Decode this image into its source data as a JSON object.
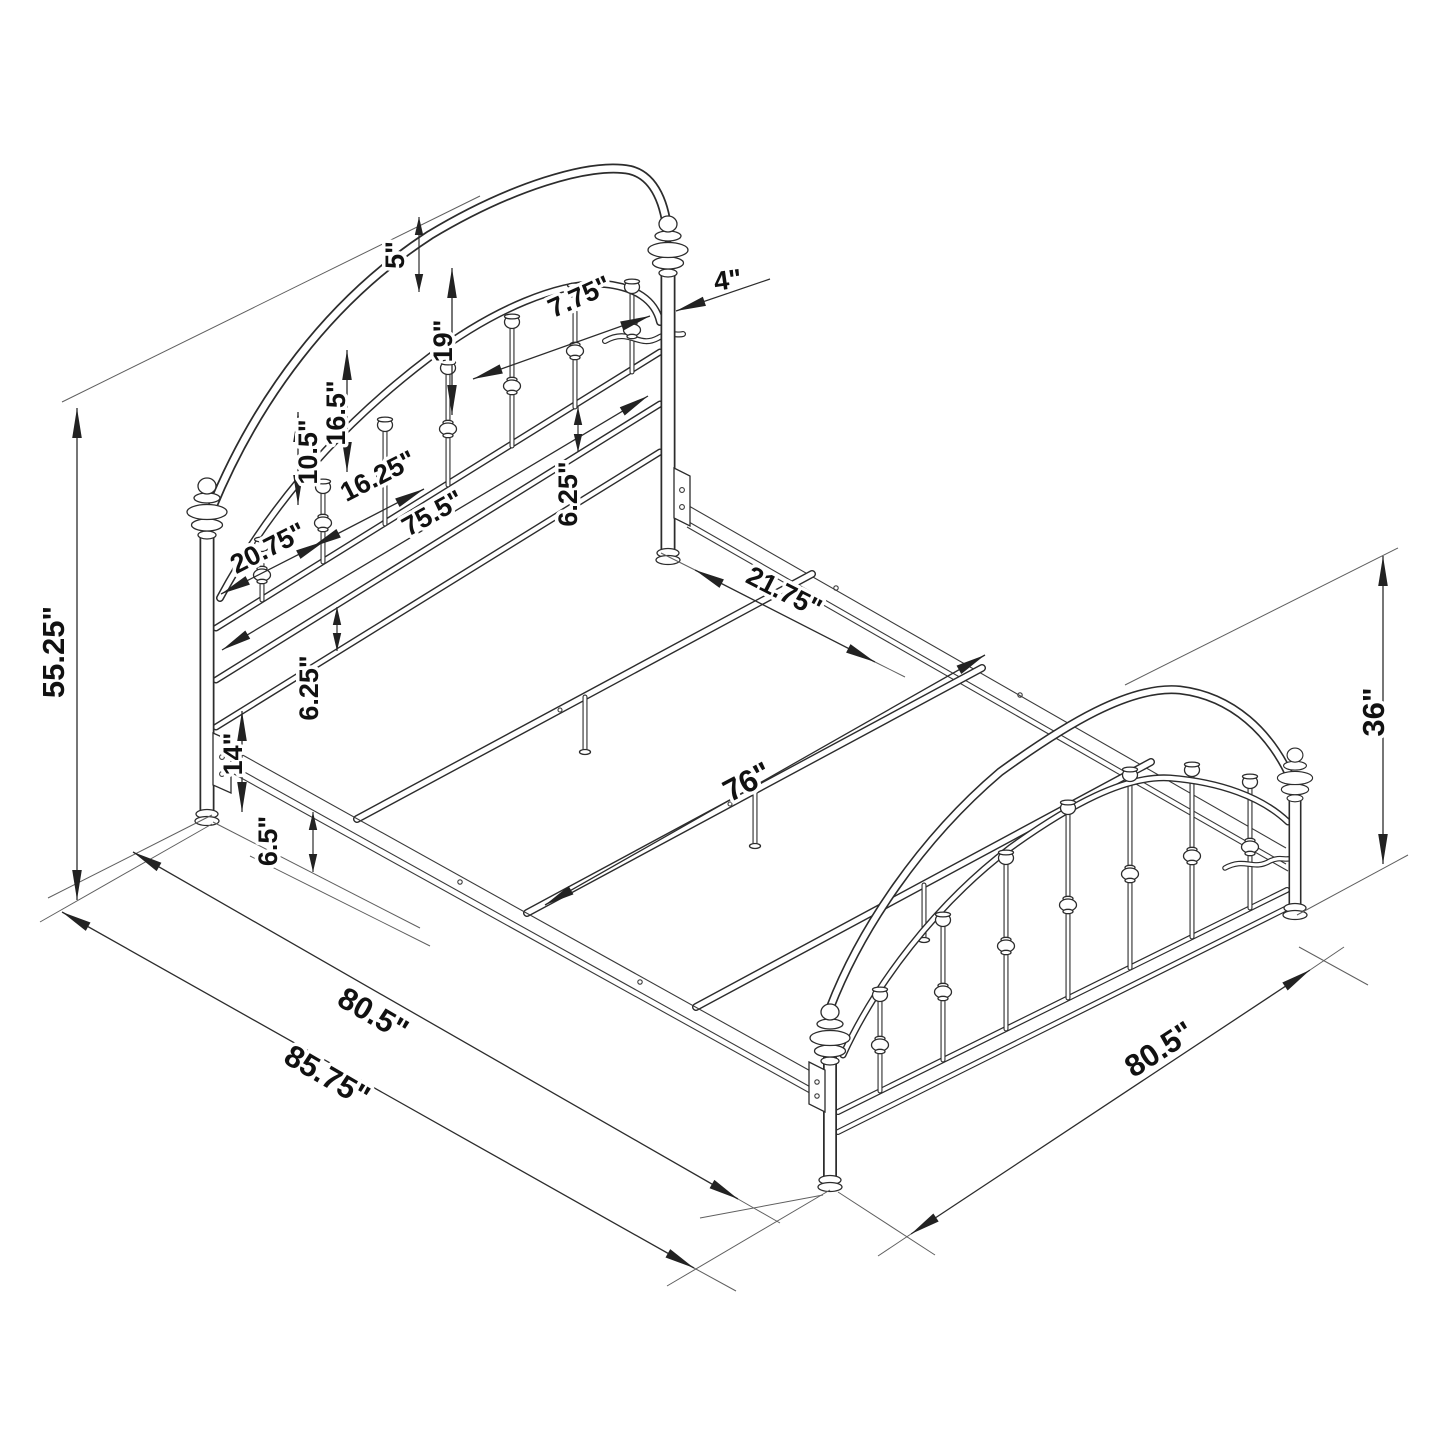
{
  "drawing": {
    "type": "isometric-dimension-diagram",
    "subject": "arched metal panel bed frame with headboard, footboard, side rails and slats"
  },
  "dimensions": {
    "headboard_height": "55.25\"",
    "headboard_arch_gap": "5\"",
    "headboard_post_offset": "4\"",
    "spindle_spacing_top": "7.75\"",
    "spindle_length_long": "19\"",
    "spindle_length_mid": "16.5\"",
    "spindle_length_short": "10.5\"",
    "spindle_spacing_bottom": "16.25\"",
    "headboard_inner_width": "75.5\"",
    "post_to_first_spindle": "20.75\"",
    "headboard_rail_gap_upper": "6.25\"",
    "headboard_rail_gap_lower": "6.25\"",
    "bottom_rail_height": "14\"",
    "side_rail_floor_gap": "6.5\"",
    "slat_spacing": "21.75\"",
    "frame_inner_width": "76\"",
    "footboard_height": "36\"",
    "frame_side_length": "80.5\"",
    "overall_length": "85.75\"",
    "footboard_side_length": "80.5\""
  },
  "colors": {
    "line": "#2c2c2c",
    "background": "#ffffff",
    "label": "#111111"
  }
}
